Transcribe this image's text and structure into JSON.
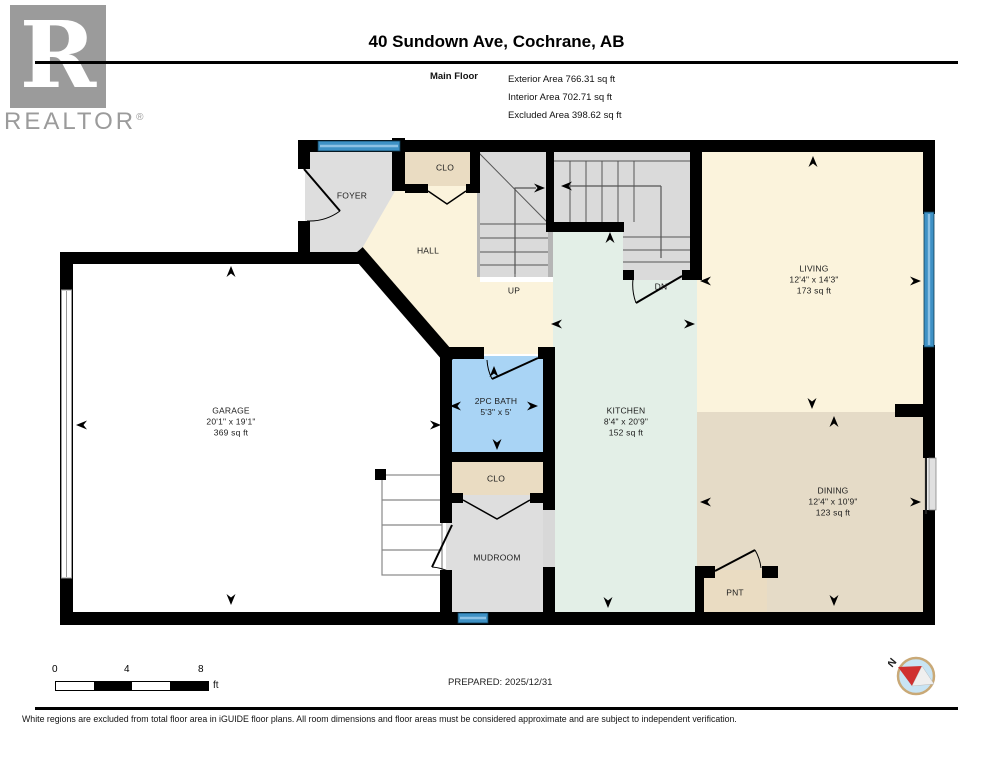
{
  "header": {
    "title": "40 Sundown Ave, Cochrane, AB",
    "floor_label": "Main Floor",
    "stats": [
      "Exterior Area 766.31 sq ft",
      "Interior Area 702.71 sq ft",
      "Excluded Area 398.62 sq ft"
    ]
  },
  "logo": {
    "letter": "R",
    "brand": "REALTOR",
    "registered": "®"
  },
  "rooms": {
    "foyer": {
      "name": "FOYER"
    },
    "clo_upper": {
      "name": "CLO"
    },
    "hall": {
      "name": "HALL"
    },
    "stairs_up": {
      "name": "UP"
    },
    "stairs_dn": {
      "name": "DN"
    },
    "living": {
      "name": "LIVING",
      "dims": "12'4\" x 14'3\"",
      "area": "173 sq ft"
    },
    "garage": {
      "name": "GARAGE",
      "dims": "20'1\" x 19'1\"",
      "area": "369 sq ft"
    },
    "bath": {
      "name": "2PC BATH",
      "dims": "5'3\" x 5'"
    },
    "kitchen": {
      "name": "KITCHEN",
      "dims": "8'4\" x 20'9\"",
      "area": "152 sq ft"
    },
    "clo_lower": {
      "name": "CLO"
    },
    "mudroom": {
      "name": "MUDROOM"
    },
    "dining": {
      "name": "DINING",
      "dims": "12'4\" x 10'9\"",
      "area": "123 sq ft"
    },
    "pantry": {
      "name": "PNT"
    }
  },
  "scale_bar": {
    "ticks": [
      "0",
      "4",
      "8"
    ],
    "unit": "ft"
  },
  "prepared": "PREPARED: 2025/12/31",
  "compass": {
    "label": "N"
  },
  "footer": "White regions are excluded from total floor area in iGUIDE floor plans. All room dimensions and floor areas must be considered approximate and are subject to independent verification.",
  "colors": {
    "wall": "#000000",
    "living_cream": "#FBF3DC",
    "dining_tan": "#E5DBC7",
    "closet_beige": "#EADCC2",
    "foyer_grey": "#DEDEDE",
    "stairs_grey": "#DADADA",
    "kitchen_mint": "#E3EFE7",
    "bath_blue": "#A9D4F5",
    "window_blue": "#3E91C5",
    "garage_white": "#FFFFFF",
    "compass_red": "#D03030",
    "logo_grey": "#9B9B9B"
  }
}
